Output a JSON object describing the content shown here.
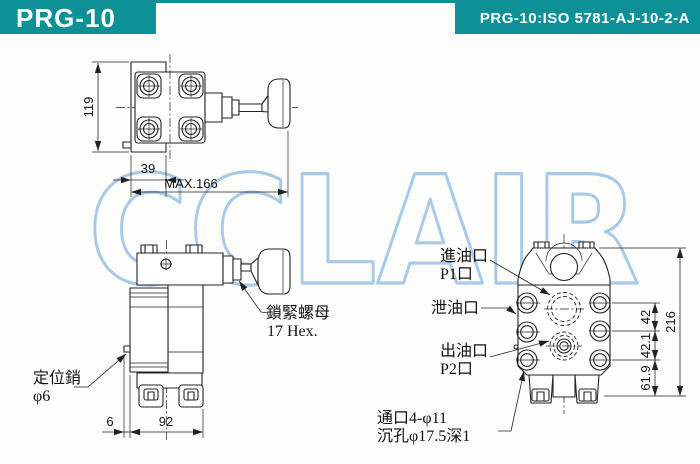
{
  "header": {
    "model": "PRG-10",
    "spec": "PRG-10:ISO 5781-AJ-10-2-A"
  },
  "watermark": {
    "text": "CCLAIR"
  },
  "colors": {
    "teal": "#0d9197",
    "watermark_blue": "#a9c9e8",
    "line": "#222222"
  },
  "top_view": {
    "dim_height": "119",
    "dim_plate_width": "39",
    "dim_max_length": "MAX.166"
  },
  "front_view": {
    "dim_pin_offset": "6",
    "dim_body_width": "92",
    "lock_nut_label": "鎖緊螺母",
    "lock_nut_size": "17 Hex.",
    "pin_label": "定位銷",
    "pin_diameter": "φ6"
  },
  "bottom_view": {
    "inlet_label": "進油口",
    "inlet_port": "P1口",
    "drain_label": "泄油口",
    "outlet_label": "出油口",
    "outlet_port": "P2口",
    "holes_label_line1": "通口4-φ11",
    "holes_label_line2": "沉孔φ17.5深1",
    "dim_port_gap1": "42",
    "dim_port_gap2": "42.1",
    "dim_port_base": "61.9",
    "dim_total_height": "216"
  }
}
